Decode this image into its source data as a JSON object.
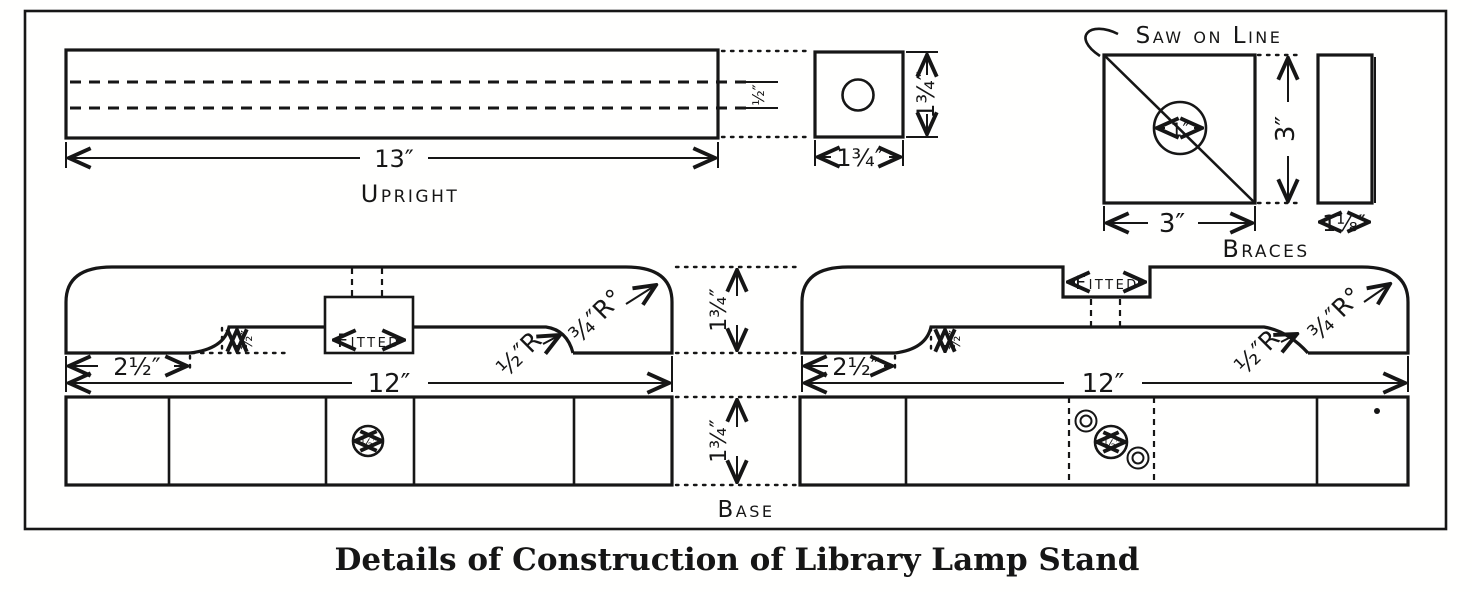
{
  "caption": "Details of Construction of Library Lamp Stand",
  "upright": {
    "label": "Upright",
    "length_dim": "13″",
    "hole_dim": "½″",
    "section_width_dim": "1¾″",
    "section_height_dim": "1¾″"
  },
  "braces": {
    "label": "Braces",
    "saw_note": "Saw on Line",
    "hole_dim": "1″",
    "width_dim": "3″",
    "height_dim": "3″",
    "thickness_dim": "1⅛″"
  },
  "base": {
    "label": "Base",
    "thickness_dim": "1¾″",
    "width_dim": "1¾″",
    "left_view": {
      "fitted_label": "Fitted",
      "foot_dim": "2½″",
      "length_dim": "12″",
      "relief_dim": "½″",
      "corner_radius": "¾″R°",
      "fillet_radius": "½″R",
      "hole_dim": "½″"
    },
    "right_view": {
      "fitted_label": "Fitted",
      "foot_dim": "2½″",
      "length_dim": "12″",
      "relief_dim": "½″",
      "corner_radius": "¾″R°",
      "fillet_radius": "½″R",
      "hole_dim": "½″"
    }
  }
}
